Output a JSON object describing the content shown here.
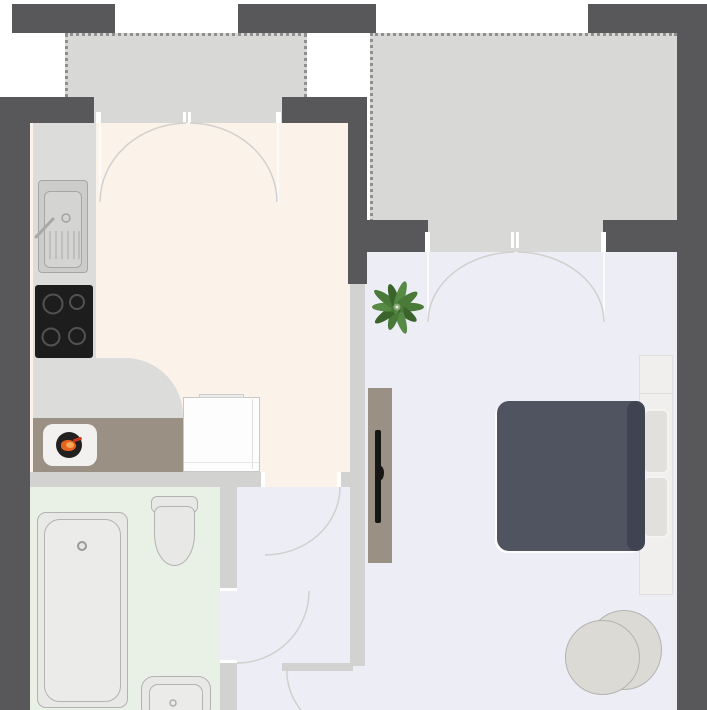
{
  "app": "floor-plan-view",
  "visible_text": [],
  "palette": {
    "wall_dark": "#58585a",
    "wall_light": "#d2d2d1",
    "balcony": "#d8d8d6",
    "balcony_dot": "#8f8f8f",
    "kitchen_floor": "#fbf2ea",
    "bath_floor": "#e9f0e5",
    "living_floor": "#ededf6",
    "counter": "#dcdcda",
    "appliance_taupe": "#9a9184",
    "cooktop": "#1d1d1d",
    "burner_ring": "#525252",
    "washer_drum": "#232120",
    "laundry_orange": "#e8631f",
    "laundry_light": "#f9a75b",
    "fixture_fill": "#e8e8e6",
    "fixture_stroke": "#b3b3b0",
    "fridge": "#fdfdfd",
    "duvet": "#505461",
    "duvet_edge": "#3f4352",
    "bed_frame": "#f0efed",
    "pillow": "#e1e0dc",
    "chair": "#dcdad5",
    "chair_stroke": "#b5b3af",
    "tv": "#161616",
    "plant_dark": "#3a642c",
    "plant_mid": "#4a7a38",
    "plant_light": "#578a44",
    "door_arc": "#d2d0cd",
    "frame_white": "#ffffff"
  },
  "rooms": [
    {
      "id": "balcony-left",
      "floor": "#d8d8d6",
      "border": "dotted"
    },
    {
      "id": "balcony-right",
      "floor": "#d8d8d6",
      "border": "dotted"
    },
    {
      "id": "kitchen",
      "floor": "#fbf2ea"
    },
    {
      "id": "bathroom",
      "floor": "#e9f0e5"
    },
    {
      "id": "hallway",
      "floor": "#ededf6"
    },
    {
      "id": "living-bedroom",
      "floor": "#ededf6"
    }
  ],
  "doors": [
    {
      "id": "french-door-balcony-left-to-kitchen",
      "type": "double-swing"
    },
    {
      "id": "french-door-balcony-right-to-living",
      "type": "double-swing"
    },
    {
      "id": "door-kitchen-to-hallway",
      "type": "single-swing"
    },
    {
      "id": "door-bathroom-to-hallway",
      "type": "single-swing"
    },
    {
      "id": "door-hallway-to-living",
      "type": "single-swing"
    }
  ],
  "furniture": {
    "kitchen": [
      "counter",
      "sink-unit",
      "cooktop-4-burners",
      "washing-machine",
      "fridge"
    ],
    "bathroom": [
      "bathtub",
      "toilet",
      "wash-basin"
    ],
    "living-bedroom": [
      "tv-sideboard",
      "tv",
      "double-bed",
      "pillows",
      "armchair",
      "potted-plant"
    ]
  }
}
